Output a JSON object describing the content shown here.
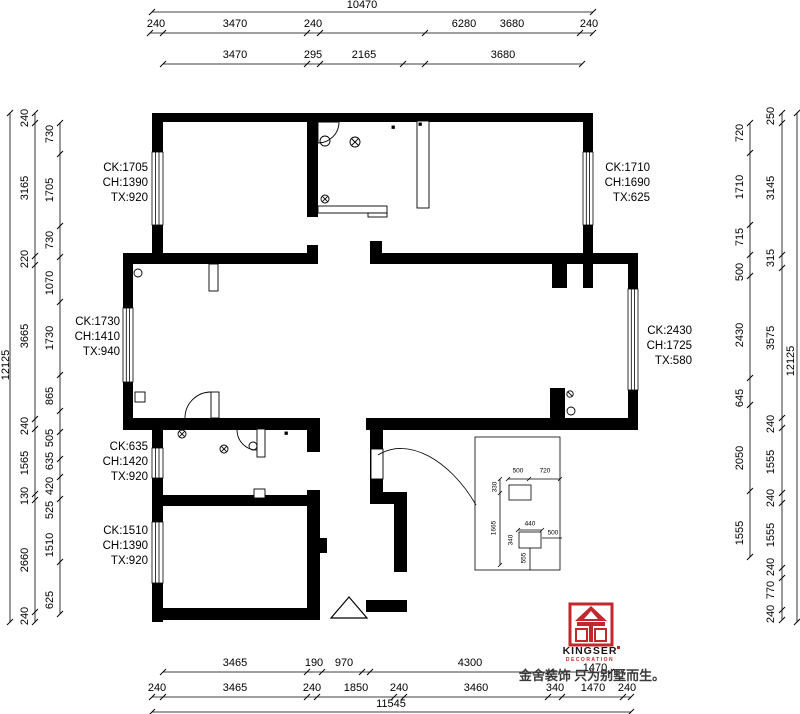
{
  "dims": {
    "top_overall": "10470",
    "top_row2": [
      "240",
      "3470",
      "240",
      "6280",
      "3680",
      "240"
    ],
    "top_row3": [
      "3470",
      "295",
      "2165",
      "3680"
    ],
    "left_overall": "12125",
    "left_outer": [
      "240",
      "3165",
      "220",
      "3665",
      "240",
      "1565",
      "130",
      "2660",
      "240"
    ],
    "left_inner": [
      "730",
      "1705",
      "730",
      "1070",
      "1730",
      "865",
      "505",
      "635",
      "420",
      "525",
      "1510",
      "625"
    ],
    "right_overall": "12125",
    "right_outer": [
      "250",
      "3145",
      "315",
      "3575",
      "240",
      "1555",
      "240",
      "1555",
      "240",
      "770",
      "240"
    ],
    "right_inner": [
      "720",
      "1710",
      "715",
      "500",
      "2430",
      "645",
      "2050",
      "1555"
    ],
    "bottom_overall": "11545",
    "bottom_row1": [
      "3465",
      "190",
      "970",
      "4300",
      "1470"
    ],
    "bottom_row2": [
      "240",
      "3465",
      "240",
      "1850",
      "240",
      "3460",
      "340",
      "1470",
      "240"
    ]
  },
  "window_notes": [
    {
      "ck": "CK:1705",
      "ch": "CH:1390",
      "tx": "TX:920"
    },
    {
      "ck": "CK:1710",
      "ch": "CH:1690",
      "tx": "TX:625"
    },
    {
      "ck": "CK:1730",
      "ch": "CH:1410",
      "tx": "TX:940"
    },
    {
      "ck": "CK:2430",
      "ch": "CH:1725",
      "tx": "TX:580"
    },
    {
      "ck": "CK:635",
      "ch": "CH:1420",
      "tx": "TX:920"
    },
    {
      "ck": "CK:1510",
      "ch": "CH:1390",
      "tx": "TX:920"
    }
  ],
  "detail_box": {
    "w_top": "500",
    "w_top2": "720",
    "h_side": "330",
    "h_side2": "1665",
    "w_mid": "440",
    "h_mid": "340",
    "w_right": "500",
    "h_bottom": "555"
  },
  "logo": {
    "brand": "KINGSER",
    "division": "DECORATION",
    "slogan": "金舍装饰 只为别墅而生。"
  },
  "colors": {
    "accent_red": "#c1272d",
    "wall_black": "#000000"
  }
}
